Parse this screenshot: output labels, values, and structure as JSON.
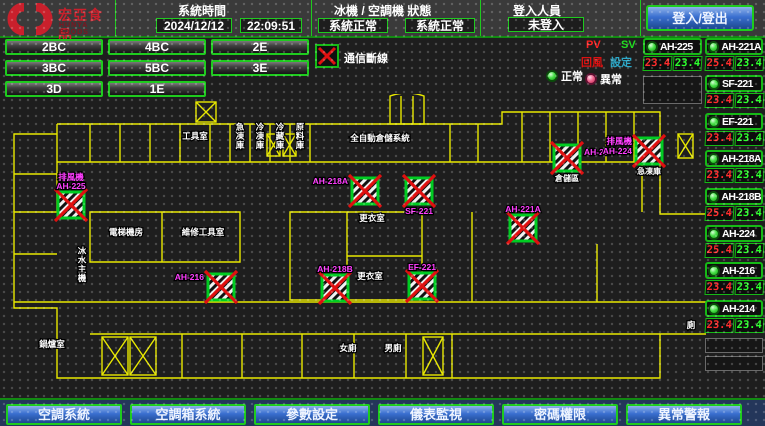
{
  "header": {
    "logo_text": "宏亞食品",
    "logo_subtext": "HUNYA FOODS",
    "system_time": {
      "title": "系統時間",
      "date": "2024/12/12",
      "time": "22:09:51"
    },
    "machine_status": {
      "title": "冰機 / 空調機 狀態",
      "chiller_status": "系統正常",
      "ac_status": "系統正常"
    },
    "login": {
      "title": "登入人員",
      "value": "未登入",
      "button_label": "登入/登出"
    }
  },
  "floor_buttons": [
    "2BC",
    "4BC",
    "2E",
    "3BC",
    "5BC",
    "3E",
    "3D",
    "1E"
  ],
  "legend": {
    "comm_loss": "通信斷線",
    "pv": "PV",
    "sv": "SV",
    "return_air": "回風",
    "setpoint": "設定",
    "normal": "正常",
    "abnormal": "異常"
  },
  "units": [
    {
      "name": "AH-225",
      "pv": "23.4",
      "sv": "23.4"
    },
    {
      "name": "AH-221A",
      "pv": "25.4",
      "sv": "23.4"
    },
    {
      "name": "SF-221",
      "pv": "23.4",
      "sv": "23.4"
    },
    {
      "name": "EF-221",
      "pv": "23.4",
      "sv": "23.4"
    },
    {
      "name": "AH-218A",
      "pv": "23.4",
      "sv": "23.4"
    },
    {
      "name": "AH-218B",
      "pv": "25.4",
      "sv": "23.4"
    },
    {
      "name": "AH-224",
      "pv": "25.4",
      "sv": "23.4"
    },
    {
      "name": "AH-216",
      "pv": "23.4",
      "sv": "23.4"
    },
    {
      "name": "AH-214",
      "pv": "23.4",
      "sv": "23.4"
    }
  ],
  "map": {
    "devices": [
      {
        "x": 56,
        "y": 98,
        "labels": [
          "排風機",
          "AH-225"
        ],
        "pos": "above"
      },
      {
        "x": 206,
        "y": 180,
        "labels": [
          "AH-216"
        ],
        "pos": "left"
      },
      {
        "x": 320,
        "y": 181,
        "labels": [
          "AH-218B"
        ],
        "pos": "above"
      },
      {
        "x": 350,
        "y": 84,
        "labels": [
          "AH-218A"
        ],
        "pos": "left"
      },
      {
        "x": 404,
        "y": 84,
        "labels": [
          "SF-221"
        ],
        "pos": "below"
      },
      {
        "x": 407,
        "y": 179,
        "labels": [
          "EF-221"
        ],
        "pos": "above"
      },
      {
        "x": 508,
        "y": 121,
        "labels": [
          "AH-221A"
        ],
        "pos": "above"
      },
      {
        "x": 552,
        "y": 51,
        "labels": [
          "AH-214"
        ],
        "pos": "right",
        "sub": "倉儲區"
      },
      {
        "x": 634,
        "y": 44,
        "labels": [
          "排風機",
          "AH-224"
        ],
        "pos": "left",
        "sub": "急凍庫"
      }
    ],
    "rooms": [
      {
        "x": 193,
        "y": 45,
        "t": "工具室"
      },
      {
        "x": 378,
        "y": 47,
        "t": "全自動倉儲系統"
      },
      {
        "x": 238,
        "y": 36,
        "t": "急凍庫",
        "vert": true
      },
      {
        "x": 258,
        "y": 36,
        "t": "冷凍庫",
        "vert": true
      },
      {
        "x": 278,
        "y": 36,
        "t": "冷藏庫",
        "vert": true
      },
      {
        "x": 298,
        "y": 36,
        "t": "原料庫",
        "vert": true
      },
      {
        "x": 370,
        "y": 127,
        "t": "更衣室"
      },
      {
        "x": 368,
        "y": 185,
        "t": "更衣室"
      },
      {
        "x": 124,
        "y": 141,
        "t": "電梯機房"
      },
      {
        "x": 201,
        "y": 141,
        "t": "維修工具室"
      },
      {
        "x": 80,
        "y": 160,
        "t": "冰水主機",
        "vert": true
      },
      {
        "x": 50,
        "y": 253,
        "t": "鍋爐室"
      },
      {
        "x": 346,
        "y": 257,
        "t": "女廁"
      },
      {
        "x": 391,
        "y": 257,
        "t": "男廁"
      },
      {
        "x": 689,
        "y": 234,
        "t": "廁",
        "vert": true
      }
    ],
    "stairs": [
      {
        "x": 100,
        "y": 243,
        "w": 26,
        "h": 38
      },
      {
        "x": 128,
        "y": 243,
        "w": 26,
        "h": 38
      },
      {
        "x": 421,
        "y": 243,
        "w": 20,
        "h": 38
      },
      {
        "x": 194,
        "y": 8,
        "w": 20,
        "h": 20
      },
      {
        "x": 265,
        "y": 40,
        "w": 13,
        "h": 22
      },
      {
        "x": 281,
        "y": 40,
        "w": 13,
        "h": 22
      },
      {
        "x": 676,
        "y": 40,
        "w": 15,
        "h": 24
      }
    ]
  },
  "nav_buttons": [
    "空調系統",
    "空調箱系統",
    "參數設定",
    "儀表監視",
    "密碼權限",
    "異常警報"
  ],
  "colors": {
    "accent_green": "#1ecb1e",
    "wall_yellow": "#e8e800",
    "label_magenta": "#ff3cff",
    "value_red": "#ff2d2d",
    "value_green": "#2dff2d",
    "alarm_x_red": "#e01010",
    "button_blue": "#3a6fd0",
    "logo_red": "#c9202c"
  }
}
